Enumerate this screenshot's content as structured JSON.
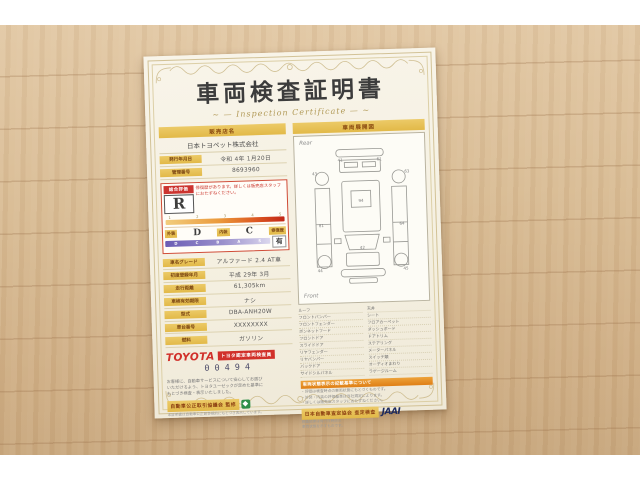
{
  "header": {
    "title": "車両検査証明書",
    "subtitle": "~ — Inspection Certificate — ~"
  },
  "dealer": {
    "header": "販売店名",
    "name": "日本トヨペット株式会社"
  },
  "meta_rows": [
    {
      "label": "発行年月日",
      "value": "令和 4年 1月20日"
    },
    {
      "label": "管理番号",
      "value": "8693960"
    }
  ],
  "evaluation": {
    "label": "総合評価",
    "grade": "R",
    "note": "修復歴があります。詳しくは販売店スタッフにおたずねください。",
    "scale_ticks": [
      "1",
      "2",
      "3",
      "4",
      "5"
    ],
    "exterior_label": "外装",
    "exterior_grade": "D",
    "interior_label": "内装",
    "interior_grade": "C",
    "grade_scale": [
      "D",
      "C",
      "B",
      "A",
      "S"
    ],
    "repair_label": "修復歴",
    "repair_value": "有"
  },
  "spec_rows": [
    {
      "label": "車名グレード",
      "value": "アルファード 2.4 AT車"
    },
    {
      "label": "初度登録年月",
      "value": "平成 29年 3月"
    },
    {
      "label": "走行距離",
      "value": "61,305km"
    },
    {
      "label": "車検有効期限",
      "value": "ナシ"
    },
    {
      "label": "型式",
      "value": "DBA-ANH20W"
    },
    {
      "label": "車台番号",
      "value": "XXXXXXXX"
    },
    {
      "label": "燃料",
      "value": "ガソリン"
    }
  ],
  "inspector": {
    "brand": "TOYOTA",
    "badge": "トヨタ認定車両検査員",
    "number": "00494"
  },
  "diagram": {
    "header": "車両展開図",
    "rear_label": "Rear",
    "front_label": "Front",
    "panel_numbers": [
      "43",
      "41",
      "61",
      "63",
      "94",
      "81",
      "64",
      "44",
      "42",
      "45"
    ]
  },
  "legend": {
    "left": [
      "ルーフ",
      "フロントバンパー",
      "フロントフェンダー",
      "ボンネットフード",
      "フロントドア",
      "スライドドア",
      "リヤフェンダー",
      "リヤバンパー",
      "バックドア",
      "サイドシルパネル"
    ],
    "right": [
      "天井",
      "シート",
      "フロアカーペット",
      "ダッシュボード",
      "ドアトリム",
      "ステアリング",
      "メーターパネル",
      "スイッチ類",
      "オーディオまわり",
      "ラゲージルーム"
    ]
  },
  "notice": {
    "header": "車両状態表示の記載基準について",
    "lines": [
      "・評価は検査時点の車両状態にもとづくものです。",
      "・外装・内装の評価基準は当社規定によります。",
      "・詳しくは販売店スタッフにおたずねください。"
    ]
  },
  "footer": {
    "left_text": [
      "お客様に、自動車サービスについて安心してお選び",
      "いただけるよう、トヨタユーゼックが定めた基準に",
      "もとづき検査・表示いたしました。"
    ],
    "fair_trade": {
      "bar": "自動車公正取引協議会 監修",
      "sub": "本証明書は自動車公正競争規約にもとづき表示しています。"
    },
    "jaai": {
      "bar": "日本自動車査定協会 査定検査",
      "logo": "JAAI",
      "side": [
        "検査結果は発行日時点の",
        "車両状態を示すものです。"
      ]
    }
  }
}
